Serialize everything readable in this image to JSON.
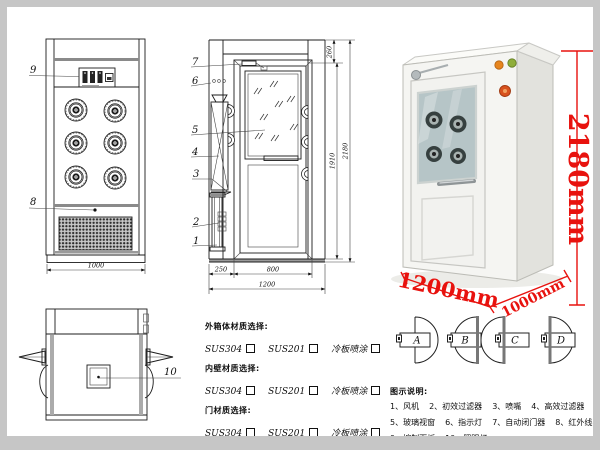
{
  "front_view": {
    "callout_control_panel": "9",
    "callout_grille": "8",
    "dim_width": "1000"
  },
  "section_view": {
    "callout_door_closer": "7",
    "callout_indicator": "6",
    "callout_glass": "5",
    "callout_fan": "4",
    "callout_bracket": "3",
    "callout_filter": "2",
    "callout_base": "1",
    "dim_top": "260",
    "dim_inner_height": "1910",
    "dim_total_height": "2180",
    "dim_side": "250",
    "dim_door": "800",
    "dim_width": "1200"
  },
  "top_view": {
    "callout_lamp": "10"
  },
  "photo": {
    "dim_height": "2180mm",
    "dim_width": "1200mm",
    "dim_depth": "1000mm"
  },
  "door_options": {
    "labels": [
      "A",
      "B",
      "C",
      "D"
    ]
  },
  "materials": {
    "sections": [
      {
        "title": "外箱体材质选择:",
        "options": [
          "SUS304",
          "SUS201",
          "冷板喷涂"
        ]
      },
      {
        "title": "内壁材质选择:",
        "options": [
          "SUS304",
          "SUS201",
          "冷板喷涂"
        ]
      },
      {
        "title": "门材质选择:",
        "options": [
          "SUS304",
          "SUS201",
          "冷板喷涂"
        ]
      }
    ]
  },
  "legend": {
    "title": "图示说明:",
    "items": [
      "1、风机",
      "2、初效过滤器",
      "3、喷嘴",
      "4、高效过滤器",
      "5、玻璃视窗",
      "6、指示灯",
      "7、自动闭门器",
      "8、红外线感应器",
      "9、控制面板",
      "10、照明灯"
    ]
  },
  "colors": {
    "dimension_red": "#e8120e",
    "line_black": "#1c1c1c",
    "frame_gray": "#c6c6c6"
  }
}
